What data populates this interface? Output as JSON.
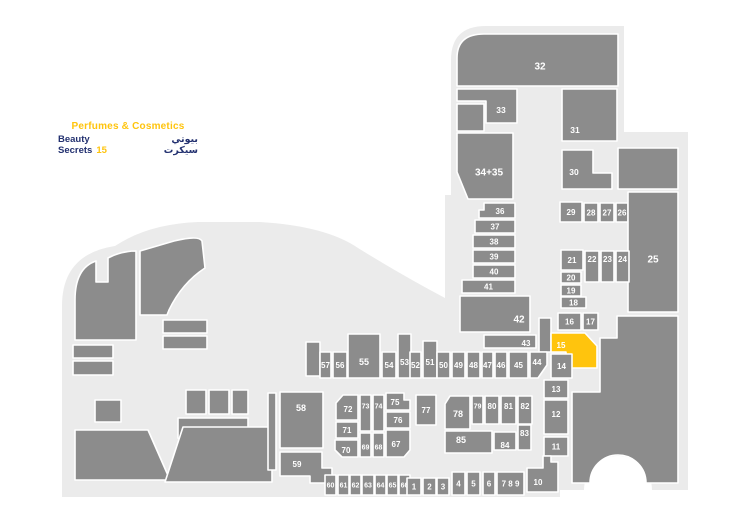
{
  "legend": {
    "category": "Perfumes & Cosmetics",
    "store_name": "Beauty Secrets",
    "store_number": "15",
    "store_name_ar": "بيوتي سيكرت"
  },
  "colors": {
    "background": "#ffffff",
    "walkway": "#ebebeb",
    "unit": "#8c8c8c",
    "unit_outline": "#ffffff",
    "highlight": "#ffc40d",
    "label": "#ffffff",
    "legend_category_color": "#ffc40d",
    "legend_store_color": "#233170"
  },
  "map": {
    "walkways": [
      {
        "d": "M451,200 L451,60 Q451,26 486,26 L624,26 L624,200 Z"
      },
      {
        "d": "M536,132 L688,132 L688,490 L652,490 A34 34 0 0 0 584,490 L536,490 Z"
      },
      {
        "d": "M445,195 L560,195 L560,497 L445,497 Z"
      },
      {
        "d": "M62,497 L62,306 Q62,254 115,246 Q148,224 198,222 L260,222 Q326,226 358,248 Q400,274 445,298 L445,497 Z"
      }
    ],
    "structures": [
      {
        "d": "M75,340 L75,300 Q75,268 96,261 L96,282 L108,282 L108,258 Q121,251 136,251 L136,340 Z"
      },
      {
        "d": "M140,251 L174,241 Q199,235 202,241 L205,268 Q182,283 169,310 L167,315 L140,315 Z"
      },
      {
        "x": 73,
        "y": 345,
        "w": 40,
        "h": 13
      },
      {
        "x": 73,
        "y": 361,
        "w": 40,
        "h": 14
      },
      {
        "x": 95,
        "y": 400,
        "w": 26,
        "h": 22
      },
      {
        "x": 163,
        "y": 320,
        "w": 44,
        "h": 13
      },
      {
        "x": 163,
        "y": 336,
        "w": 44,
        "h": 13
      },
      {
        "x": 186,
        "y": 390,
        "w": 20,
        "h": 24
      },
      {
        "x": 209,
        "y": 390,
        "w": 20,
        "h": 24
      },
      {
        "x": 232,
        "y": 390,
        "w": 16,
        "h": 24
      },
      {
        "d": "M178,418 L248,418 L248,452 L196,452 L178,438 Z"
      },
      {
        "d": "M75,430 L148,430 L170,480 L75,480 Z"
      },
      {
        "d": "M183,427 L272,427 L272,482 L165,482 Z"
      },
      {
        "x": 268,
        "y": 393,
        "w": 8,
        "h": 77
      },
      {
        "x": 306,
        "y": 342,
        "w": 14,
        "h": 34
      },
      {
        "x": 457,
        "y": 104,
        "w": 27,
        "h": 27
      },
      {
        "x": 618,
        "y": 148,
        "w": 60,
        "h": 41
      },
      {
        "x": 539,
        "y": 318,
        "w": 12,
        "h": 34
      },
      {
        "d": "M572,483 L572,392 L600,392 L600,338 L617,338 L617,316 L678,316 L678,483 L646,483 A28 28 0 0 0 590,483 Z"
      }
    ],
    "units": [
      {
        "id": "32",
        "d": "M457,86 L457,58 Q457,34 484,34 L618,34 L618,86 Z",
        "lx": 540,
        "ly": 66,
        "fs": 10
      },
      {
        "id": "33",
        "d": "M457,89 L517,89 L517,123 L486,123 L486,101 L457,101 Z",
        "lx": 501,
        "ly": 110
      },
      {
        "id": "34+35",
        "d": "M457,133 L513,133 L513,199 L468,199 L457,172 Z",
        "lx": 489,
        "ly": 172,
        "fs": 10
      },
      {
        "id": "31",
        "x": 562,
        "y": 89,
        "w": 55,
        "h": 52,
        "lx": 575,
        "ly": 130
      },
      {
        "id": "30",
        "d": "M562,150 L593,150 L593,173 L612,173 L612,189 L562,189 Z",
        "lx": 574,
        "ly": 172
      },
      {
        "id": "29",
        "x": 560,
        "y": 202,
        "w": 22,
        "h": 20,
        "fs": 8
      },
      {
        "id": "28",
        "x": 584,
        "y": 203,
        "w": 14,
        "h": 19,
        "fs": 8
      },
      {
        "id": "27",
        "x": 600,
        "y": 203,
        "w": 14,
        "h": 19,
        "fs": 8
      },
      {
        "id": "26",
        "x": 616,
        "y": 203,
        "w": 12,
        "h": 19,
        "fs": 8
      },
      {
        "id": "25",
        "x": 628,
        "y": 192,
        "w": 50,
        "h": 120,
        "ly": 259,
        "fs": 10
      },
      {
        "id": "21",
        "x": 561,
        "y": 250,
        "w": 22,
        "h": 20,
        "fs": 8
      },
      {
        "id": "22",
        "x": 585,
        "y": 251,
        "w": 14,
        "h": 31,
        "ly": 259,
        "fs": 8
      },
      {
        "id": "23",
        "x": 601,
        "y": 251,
        "w": 13,
        "h": 31,
        "ly": 259,
        "fs": 8
      },
      {
        "id": "24",
        "x": 616,
        "y": 251,
        "w": 13,
        "h": 31,
        "ly": 259,
        "fs": 8
      },
      {
        "id": "20",
        "x": 561,
        "y": 272,
        "w": 20,
        "h": 11,
        "fs": 8
      },
      {
        "id": "19",
        "x": 561,
        "y": 285,
        "w": 20,
        "h": 11,
        "fs": 8
      },
      {
        "id": "18",
        "x": 561,
        "y": 297,
        "w": 25,
        "h": 11,
        "fs": 8
      },
      {
        "id": "16",
        "x": 558,
        "y": 313,
        "w": 23,
        "h": 17,
        "fs": 8
      },
      {
        "id": "17",
        "x": 583,
        "y": 313,
        "w": 15,
        "h": 17,
        "fs": 8
      },
      {
        "id": "15",
        "highlight": true,
        "d": "M551,333 L585,333 L597,346 L597,368 L566,368 L566,352 L551,352 Z",
        "lx": 561,
        "ly": 345,
        "fs": 8
      },
      {
        "id": "14",
        "x": 551,
        "y": 354,
        "w": 21,
        "h": 24,
        "fs": 8
      },
      {
        "id": "13",
        "x": 544,
        "y": 380,
        "w": 24,
        "h": 18,
        "fs": 8
      },
      {
        "id": "12",
        "x": 544,
        "y": 400,
        "w": 24,
        "h": 34,
        "ly": 414,
        "fs": 8
      },
      {
        "id": "11",
        "x": 544,
        "y": 437,
        "w": 24,
        "h": 19,
        "fs": 8
      },
      {
        "id": "10",
        "d": "M527,468 L543,468 L543,456 L551,456 L551,462 L558,462 L558,492 L527,492 Z",
        "lx": 538,
        "ly": 482,
        "fs": 8
      },
      {
        "id": "36",
        "d": "M479,210 L484,210 L484,203 L515,203 L515,218 L479,218 Z",
        "lx": 500,
        "ly": 211,
        "fs": 8
      },
      {
        "id": "37",
        "x": 475,
        "y": 220,
        "w": 40,
        "h": 13,
        "fs": 8
      },
      {
        "id": "38",
        "x": 473,
        "y": 235,
        "w": 42,
        "h": 13,
        "fs": 8
      },
      {
        "id": "39",
        "x": 473,
        "y": 250,
        "w": 42,
        "h": 13,
        "fs": 8
      },
      {
        "id": "40",
        "x": 473,
        "y": 265,
        "w": 42,
        "h": 13,
        "fs": 8
      },
      {
        "id": "41",
        "x": 462,
        "y": 280,
        "w": 53,
        "h": 13,
        "fs": 8
      },
      {
        "id": "42",
        "x": 460,
        "y": 296,
        "w": 70,
        "h": 36,
        "lx": 519,
        "ly": 319,
        "fs": 10
      },
      {
        "id": "43",
        "x": 484,
        "y": 335,
        "w": 52,
        "h": 13,
        "lx": 526,
        "ly": 343,
        "fs": 8
      },
      {
        "id": "57",
        "x": 320,
        "y": 352,
        "w": 11,
        "h": 26,
        "fs": 8
      },
      {
        "id": "56",
        "x": 333,
        "y": 352,
        "w": 14,
        "h": 26,
        "fs": 8
      },
      {
        "id": "55",
        "x": 348,
        "y": 334,
        "w": 32,
        "h": 44,
        "ly": 362,
        "fs": 9
      },
      {
        "id": "54",
        "x": 382,
        "y": 352,
        "w": 14,
        "h": 26,
        "fs": 8
      },
      {
        "id": "53",
        "x": 398,
        "y": 334,
        "w": 13,
        "h": 44,
        "ly": 362,
        "fs": 8
      },
      {
        "id": "52",
        "x": 410,
        "y": 352,
        "w": 11,
        "h": 26,
        "fs": 8
      },
      {
        "id": "51",
        "x": 423,
        "y": 341,
        "w": 14,
        "h": 37,
        "ly": 362,
        "fs": 8
      },
      {
        "id": "50",
        "x": 437,
        "y": 352,
        "w": 13,
        "h": 26,
        "fs": 8
      },
      {
        "id": "49",
        "x": 452,
        "y": 352,
        "w": 13,
        "h": 26,
        "fs": 8
      },
      {
        "id": "48",
        "x": 467,
        "y": 352,
        "w": 13,
        "h": 26,
        "fs": 8
      },
      {
        "id": "47",
        "x": 482,
        "y": 352,
        "w": 11,
        "h": 26,
        "fs": 8
      },
      {
        "id": "46",
        "x": 495,
        "y": 352,
        "w": 12,
        "h": 26,
        "fs": 8
      },
      {
        "id": "45",
        "x": 509,
        "y": 352,
        "w": 19,
        "h": 26,
        "fs": 8
      },
      {
        "id": "44",
        "d": "M530,352 L547,352 L547,365 L538,378 L530,378 Z",
        "lx": 537,
        "ly": 362,
        "fs": 8
      },
      {
        "id": "72",
        "d": "M343,395 L358,395 L358,420 L336,420 L336,403 Z",
        "lx": 348,
        "ly": 409,
        "fs": 8
      },
      {
        "id": "73",
        "x": 360,
        "y": 395,
        "w": 11,
        "h": 36,
        "ly": 406,
        "fs": 7
      },
      {
        "id": "74",
        "x": 373,
        "y": 395,
        "w": 11,
        "h": 36,
        "ly": 406,
        "fs": 7
      },
      {
        "id": "75",
        "d": "M386,393 L404,393 L404,400 L410,400 L410,410 L386,410 Z",
        "lx": 395,
        "ly": 402,
        "fs": 8
      },
      {
        "id": "76",
        "x": 386,
        "y": 412,
        "w": 24,
        "h": 16,
        "fs": 8
      },
      {
        "id": "71",
        "x": 336,
        "y": 422,
        "w": 22,
        "h": 16,
        "fs": 8
      },
      {
        "id": "70",
        "d": "M335,440 L358,440 L358,457 L342,457 L335,450 Z",
        "lx": 346,
        "ly": 450,
        "fs": 8
      },
      {
        "id": "69",
        "x": 360,
        "y": 433,
        "w": 11,
        "h": 24,
        "ly": 447,
        "fs": 7
      },
      {
        "id": "68",
        "x": 373,
        "y": 433,
        "w": 11,
        "h": 24,
        "ly": 447,
        "fs": 7
      },
      {
        "id": "67",
        "d": "M386,430 L410,430 L410,450 L404,457 L386,457 Z",
        "lx": 396,
        "ly": 444,
        "fs": 8
      },
      {
        "id": "77",
        "x": 416,
        "y": 395,
        "w": 20,
        "h": 30,
        "ly": 410,
        "fs": 8
      },
      {
        "id": "78",
        "d": "M450,396 L470,396 L470,429 L445,429 L445,404 Z",
        "lx": 458,
        "ly": 414,
        "fs": 9
      },
      {
        "id": "79",
        "x": 472,
        "y": 396,
        "w": 11,
        "h": 28,
        "ly": 406,
        "fs": 7
      },
      {
        "id": "80",
        "x": 485,
        "y": 396,
        "w": 14,
        "h": 28,
        "ly": 406,
        "fs": 8
      },
      {
        "id": "81",
        "x": 501,
        "y": 396,
        "w": 15,
        "h": 28,
        "ly": 406,
        "fs": 8
      },
      {
        "id": "82",
        "x": 518,
        "y": 396,
        "w": 14,
        "h": 28,
        "ly": 406,
        "fs": 8
      },
      {
        "id": "85",
        "x": 445,
        "y": 431,
        "w": 47,
        "h": 22,
        "lx": 461,
        "ly": 440,
        "fs": 9
      },
      {
        "id": "84",
        "x": 494,
        "y": 432,
        "w": 22,
        "h": 18,
        "lx": 505,
        "ly": 445,
        "fs": 8
      },
      {
        "id": "83",
        "x": 518,
        "y": 425,
        "w": 13,
        "h": 25,
        "ly": 433,
        "fs": 8
      },
      {
        "id": "58",
        "x": 280,
        "y": 392,
        "w": 43,
        "h": 56,
        "lx": 301,
        "ly": 408,
        "fs": 9
      },
      {
        "id": "59",
        "d": "M280,452 L322,452 L322,468 L332,468 L332,483 L310,483 L310,476 L280,476 Z",
        "lx": 297,
        "ly": 464,
        "fs": 8
      },
      {
        "id": "60",
        "x": 325,
        "y": 475,
        "w": 11,
        "h": 20,
        "fs": 7
      },
      {
        "id": "61",
        "x": 338,
        "y": 475,
        "w": 11,
        "h": 20,
        "fs": 7
      },
      {
        "id": "62",
        "x": 350,
        "y": 475,
        "w": 11,
        "h": 20,
        "fs": 7
      },
      {
        "id": "63",
        "x": 362,
        "y": 475,
        "w": 12,
        "h": 20,
        "fs": 7
      },
      {
        "id": "64",
        "x": 375,
        "y": 475,
        "w": 11,
        "h": 20,
        "fs": 7
      },
      {
        "id": "65",
        "x": 387,
        "y": 475,
        "w": 11,
        "h": 20,
        "fs": 7
      },
      {
        "id": "66",
        "x": 399,
        "y": 475,
        "w": 11,
        "h": 20,
        "fs": 7
      },
      {
        "id": "1",
        "x": 407,
        "y": 478,
        "w": 14,
        "h": 17,
        "fs": 8
      },
      {
        "id": "2",
        "x": 423,
        "y": 478,
        "w": 13,
        "h": 17,
        "fs": 8
      },
      {
        "id": "3",
        "x": 437,
        "y": 478,
        "w": 12,
        "h": 17,
        "fs": 8
      },
      {
        "id": "4",
        "x": 452,
        "y": 472,
        "w": 13,
        "h": 23,
        "fs": 8
      },
      {
        "id": "5",
        "x": 467,
        "y": 472,
        "w": 13,
        "h": 23,
        "fs": 8
      },
      {
        "id": "6",
        "x": 483,
        "y": 472,
        "w": 12,
        "h": 23,
        "fs": 8
      },
      {
        "id": "7 8 9",
        "x": 497,
        "y": 472,
        "w": 27,
        "h": 23,
        "fs": 8
      },
      {
        "id": "10b",
        "label": "10",
        "skip": true
      }
    ]
  }
}
